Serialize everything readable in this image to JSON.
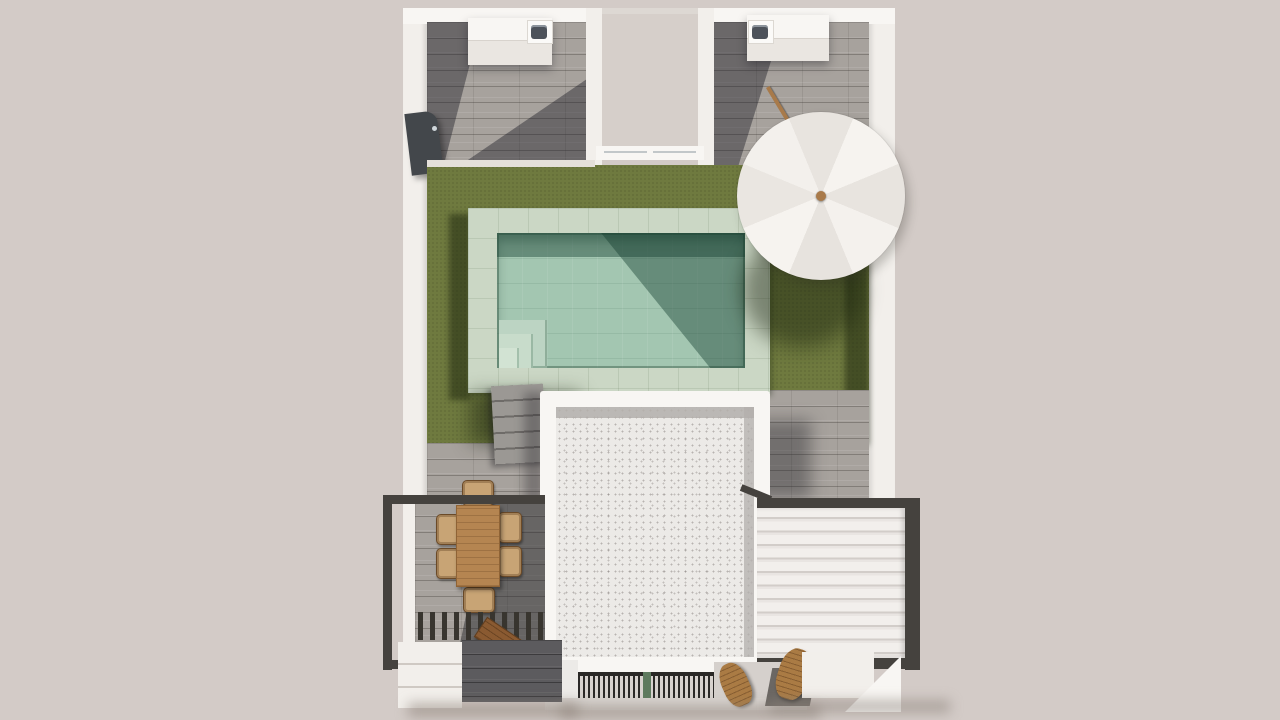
{
  "scene": {
    "kind": "top-down 3d architectural render",
    "subject": "villa roof terrace and backyard with swimming pool",
    "text_visible": "none"
  },
  "palette": {
    "background": "#d3cbc7",
    "wall": "#f2efeb",
    "wall_bright": "#f8f6f3",
    "wall_dim": "#ddd8d3",
    "tile": "#a7a29d",
    "tile_dark": "#5c5b5e",
    "grass": "#6f7a3f",
    "grass_shadow": "#3c4a22",
    "coping": "#cbd7c5",
    "water": "#a3c6b1",
    "water_shadow": "#55806d",
    "gravel": "#eceae7",
    "gravel_band": "#b3afac",
    "frame_dark": "#45423e",
    "louver_hi": "#f2efec",
    "louver_lo": "#d2cdc9",
    "grate_dark": "#2b2927",
    "grate_light": "#d7d2ce",
    "green_strip": "#5e7a5e",
    "wood_table": "#b58551",
    "wicker": "#c8a475",
    "bench_wood": "#8a5a31",
    "lounge_wood": "#aa7b44",
    "mat_gray": "#6b6763",
    "umbrella_hi": "#f6f3ef",
    "umbrella_lo": "#e8e4df",
    "knob_wood": "#a97a4a",
    "appliance": "#4d525a",
    "sill": "#d8d3cf"
  },
  "inventory": {
    "parasol_panels": 8,
    "dining_chairs": 6,
    "louver_slats": 11,
    "pool_steps": 3,
    "garden_step_treads": 5,
    "outdoor_sink_units": 2,
    "lounge_chairs": 2
  }
}
